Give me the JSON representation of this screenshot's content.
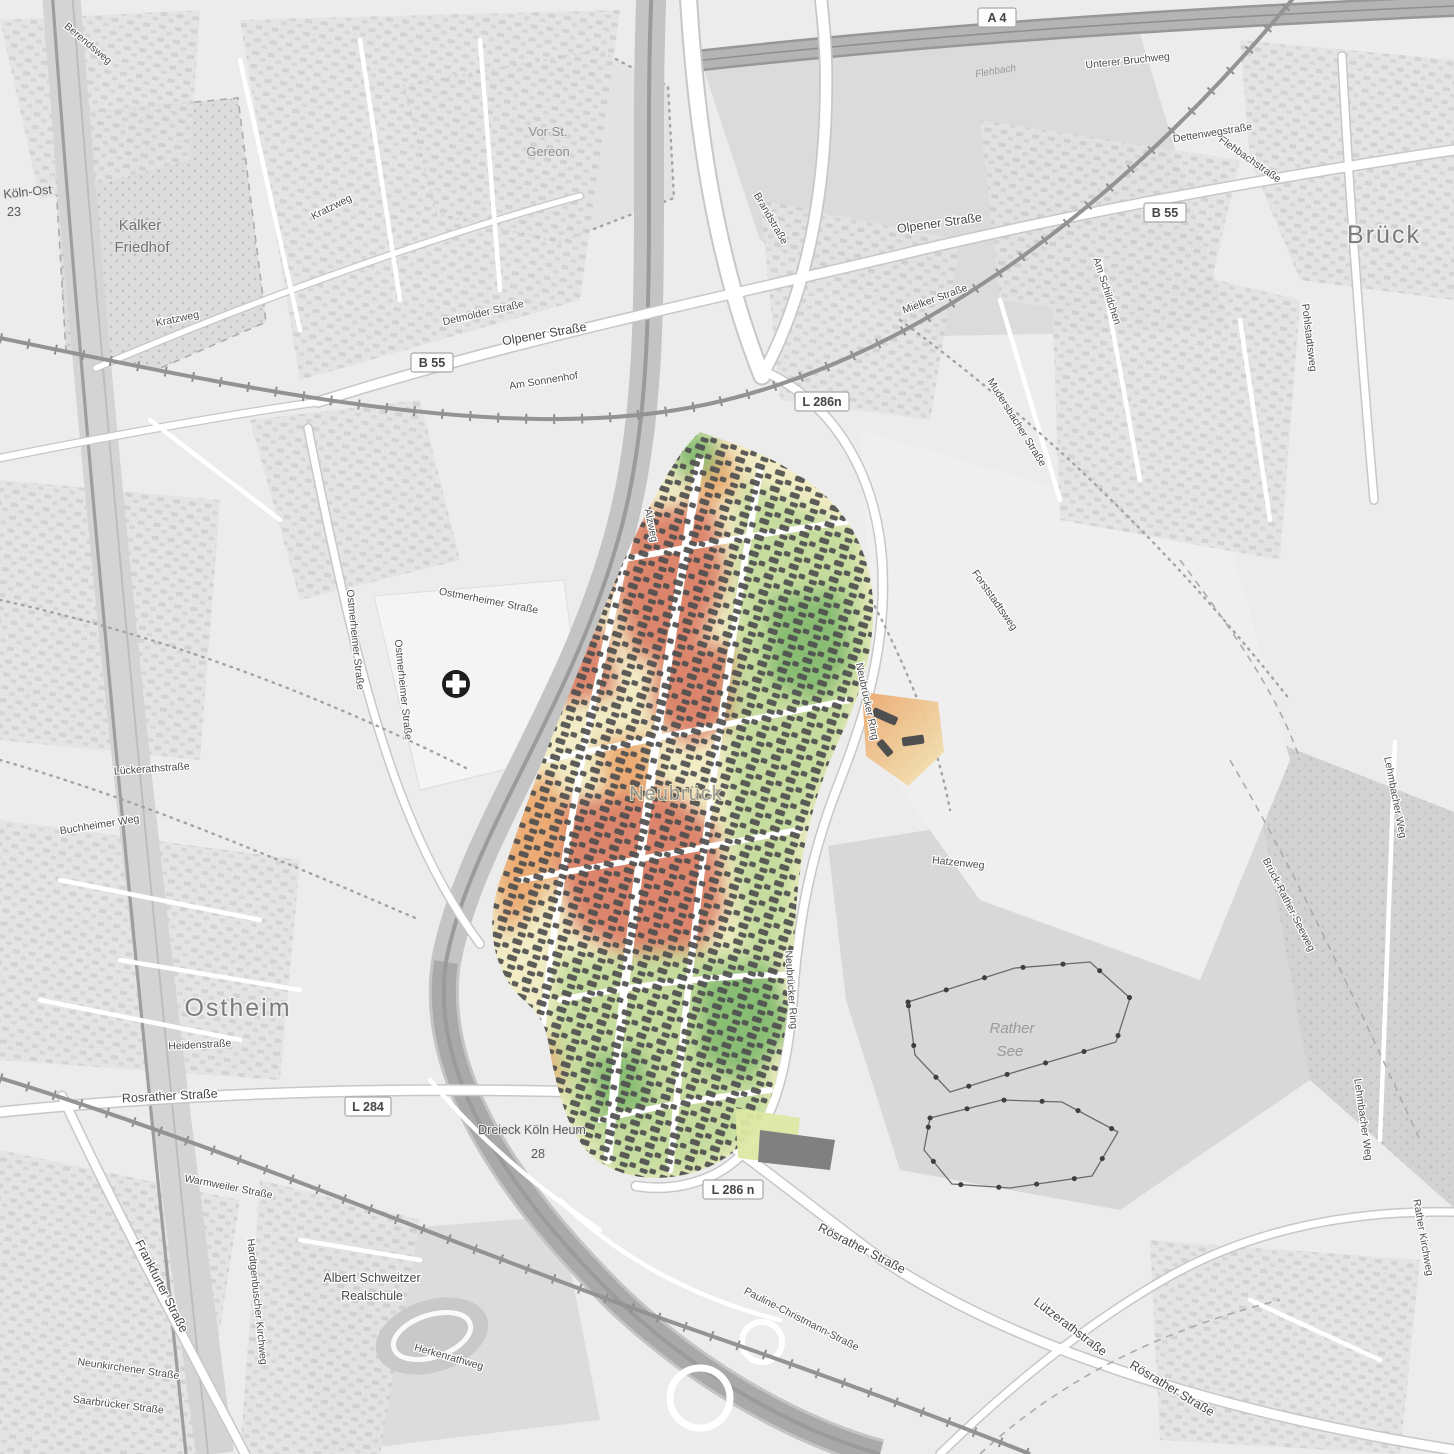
{
  "badges": [
    {
      "text": "A 4"
    },
    {
      "text": "B 55"
    },
    {
      "text": "B 55"
    },
    {
      "text": "L 286n"
    },
    {
      "text": "L 284"
    },
    {
      "text": "L 286 n"
    }
  ],
  "labels": [
    {
      "text": "Brück"
    },
    {
      "text": "Ostheim"
    },
    {
      "text": "Neubrück"
    },
    {
      "text": "Kalker"
    },
    {
      "text": "Friedhof"
    },
    {
      "text": "Vor St."
    },
    {
      "text": "Gereon"
    },
    {
      "text": "Rather"
    },
    {
      "text": "See"
    },
    {
      "text": "Albert Schweitzer"
    },
    {
      "text": "Realschule"
    },
    {
      "text": "Köln-Ost"
    },
    {
      "text": "23"
    },
    {
      "text": "Dreieck Köln Heum"
    },
    {
      "text": "28"
    },
    {
      "text": "Olpener Straße"
    },
    {
      "text": "Olpener Straße"
    },
    {
      "text": "Rosrather Straße"
    },
    {
      "text": "Rösrather Straße"
    },
    {
      "text": "Rösrather Straße"
    },
    {
      "text": "Frankfurter Straße"
    },
    {
      "text": "Ostmerheimer Straße"
    },
    {
      "text": "Ostmerheimer Straße"
    },
    {
      "text": "Ostmerheimer Straße"
    },
    {
      "text": "Neubrücker Ring"
    },
    {
      "text": "Neubrücker Ring"
    },
    {
      "text": "Kratzweg"
    },
    {
      "text": "Kratzweg"
    },
    {
      "text": "Flehbachstraße"
    },
    {
      "text": "Dettenwegstraße"
    },
    {
      "text": "Unterer Bruchweg"
    },
    {
      "text": "Flehbach"
    },
    {
      "text": "Brandstraße"
    },
    {
      "text": "Mielker Straße"
    },
    {
      "text": "Mudersbacher Straße"
    },
    {
      "text": "Pohlstadtsweg"
    },
    {
      "text": "Am Schildchen"
    },
    {
      "text": "Lehmbacher Weg"
    },
    {
      "text": "Lehmbacher Weg"
    },
    {
      "text": "Brück-Rather-Seeweg"
    },
    {
      "text": "Rather Kirchweg"
    },
    {
      "text": "Lützerathstraße"
    },
    {
      "text": "Pauline-Christmann-Straße"
    },
    {
      "text": "Hatzenweg"
    },
    {
      "text": "Buchheimer Weg"
    },
    {
      "text": "Lückerathstraße"
    },
    {
      "text": "Heidenstraße"
    },
    {
      "text": "Warmweiler Straße"
    },
    {
      "text": "Neunkirchener Straße"
    },
    {
      "text": "Saarbrücker Straße"
    },
    {
      "text": "Hardtgenbuscher Kirchweg"
    },
    {
      "text": "Am Sonnenhof"
    },
    {
      "text": "Detmolder Straße"
    },
    {
      "text": "Berendsweg"
    },
    {
      "text": "Forststadtsweg"
    },
    {
      "text": "Herkenrathweg"
    },
    {
      "text": "Alzweg"
    }
  ],
  "poi": {
    "hospital_symbol": "+"
  },
  "overlay_colors": {
    "very_low": "#db8068",
    "low": "#eba86f",
    "neutral": "#f1ecc3",
    "good": "#c3dc9c",
    "very_good": "#83bb70",
    "building": "#4f4f4f"
  }
}
